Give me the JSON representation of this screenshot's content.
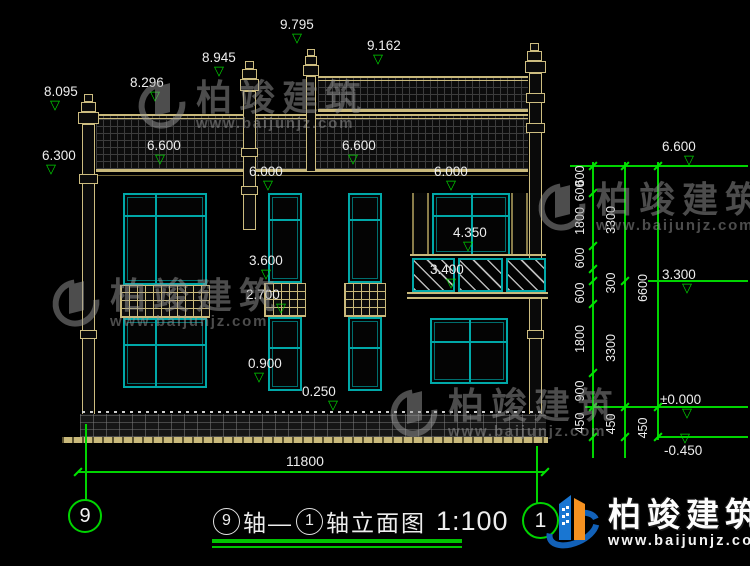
{
  "watermark": {
    "brand": "柏竣建筑",
    "url": "www.baijunjz.com"
  },
  "footer": {
    "brand": "柏竣建筑",
    "url": "www.baijunjz.com"
  },
  "title": {
    "axis_start": "9",
    "seg1": "轴—",
    "axis_end": "1",
    "seg2": "轴立面图",
    "scale": "1:100"
  },
  "axes": {
    "left": "9",
    "right": "1"
  },
  "dims": {
    "overall": "11800",
    "col1": [
      "600",
      "600",
      "1800",
      "600",
      "600",
      "1800",
      "900",
      "450"
    ],
    "col2": [
      "3300",
      "300",
      "3300",
      "450"
    ],
    "col3": [
      "6600",
      "450"
    ]
  },
  "levels": {
    "t8095": "8.095",
    "t8296": "8.296",
    "t8945": "8.945",
    "t9795": "9.795",
    "t9162": "9.162",
    "t6300": "6.300",
    "t6600a": "6.600",
    "t6600b": "6.600",
    "t6000a": "6.000",
    "t6000b": "6.000",
    "t3600": "3.600",
    "t2700": "2.700",
    "t0900": "0.900",
    "t0250": "0.250",
    "t4350": "4.350",
    "t3400": "3.400",
    "r6600": "6.600",
    "r3300": "3.300",
    "r0000": "±0.000",
    "rm0450": "-0.450"
  }
}
